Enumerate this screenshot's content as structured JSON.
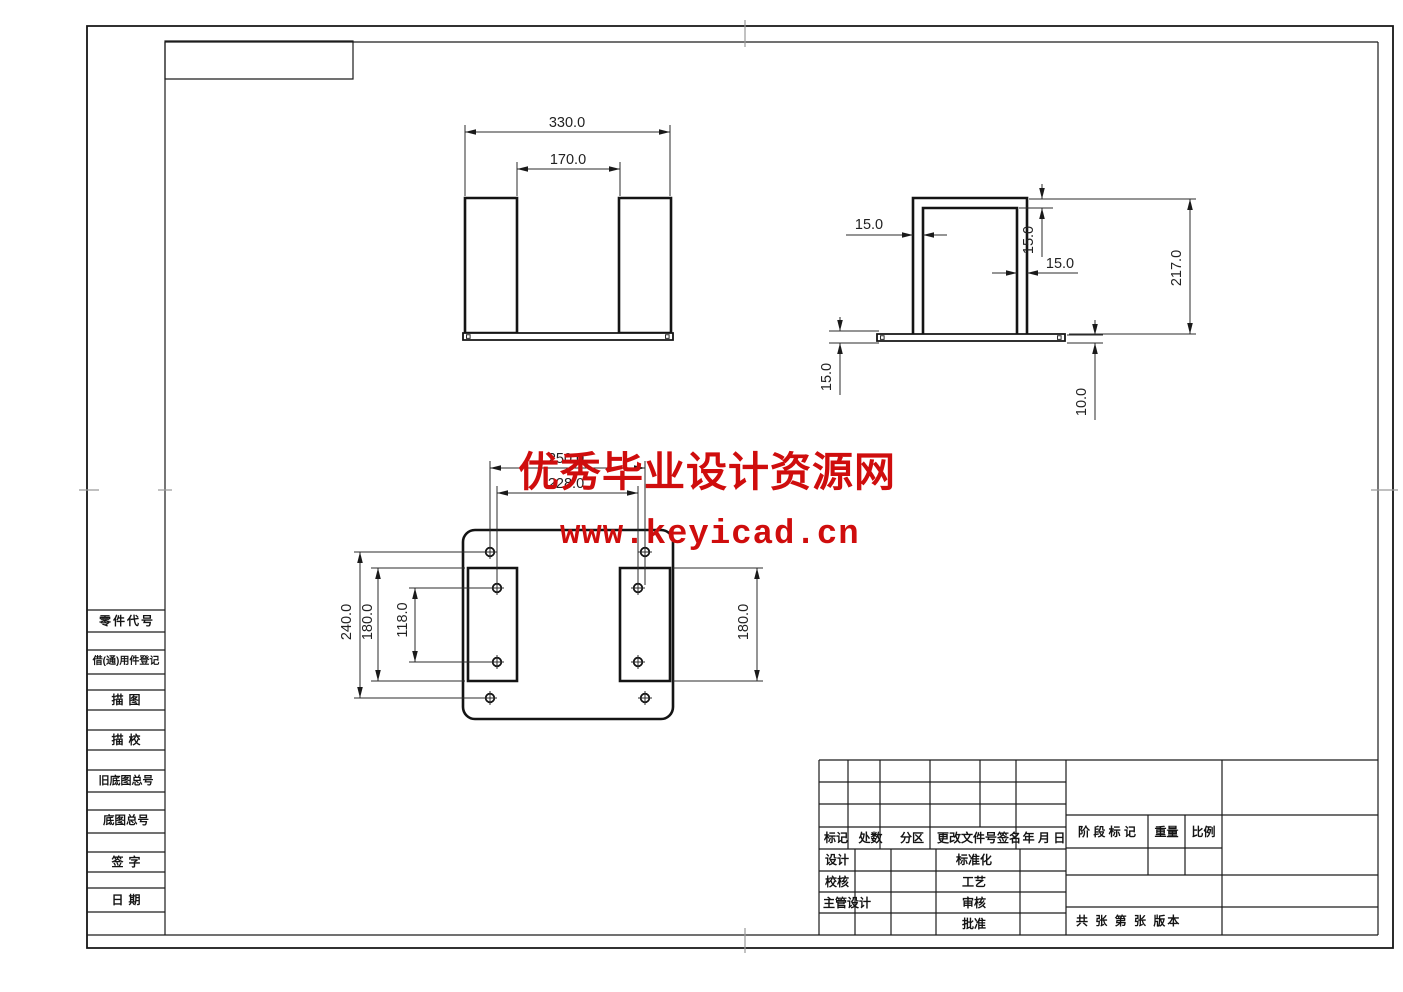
{
  "watermark": {
    "line1": "优秀毕业设计资源网",
    "line2": "www.keyicad.cn",
    "color": "#cf0d0d"
  },
  "sidebar": {
    "labels": [
      "零件代号",
      "借(通)用件登记",
      "描图",
      "描校",
      "旧底图总号",
      "底图总号",
      "签字",
      "日期"
    ]
  },
  "title_block": {
    "header": {
      "mark": "标记",
      "count": "处数",
      "zone": "分区",
      "change": "更改文件号签名",
      "date": "年 月 日"
    },
    "cells": {
      "design": "设计",
      "check": "校核",
      "chief": "主管设计",
      "standard": "标准化",
      "process": "工艺",
      "review": "审核",
      "approve": "批准"
    },
    "right": {
      "stage": "阶 段 标 记",
      "weight": "重量",
      "scale": "比例",
      "sheet": "共  张 第  张 版本"
    }
  },
  "views": {
    "front": {
      "width": "330.0",
      "opening": "170.0"
    },
    "side": {
      "wall_left": "15.0",
      "top": "15.0",
      "wall_right": "15.0",
      "height": "217.0",
      "flange": "15.0",
      "base": "10.0"
    },
    "bottom": {
      "holes_span": "250.0",
      "holes_inner_span": "228.0",
      "height": "240.0",
      "pocket_left": "180.0",
      "holes_pitch": "118.0",
      "pocket_right": "180.0"
    }
  },
  "colors": {
    "line": "#141414",
    "dim_text": "#222222",
    "watermark": "#cf0d0d"
  }
}
